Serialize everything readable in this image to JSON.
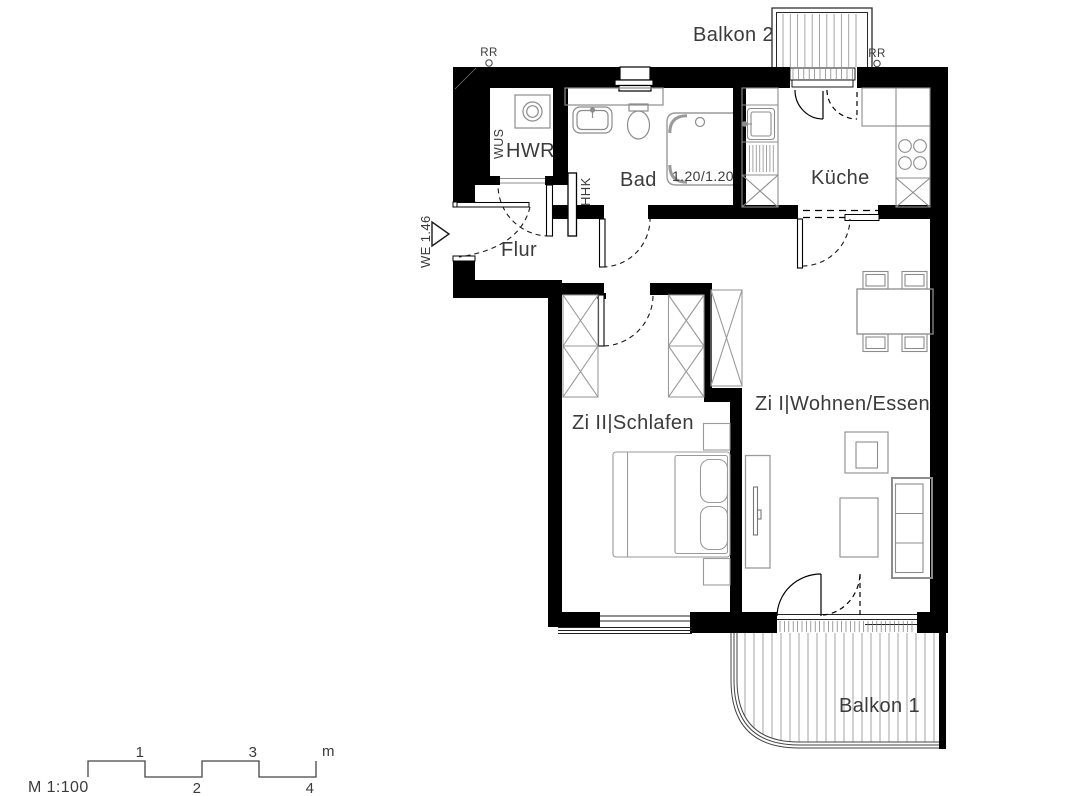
{
  "labels": {
    "balkon2": "Balkon 2",
    "balkon1": "Balkon 1",
    "hwr": "HWR",
    "bad": "Bad",
    "kueche": "Küche",
    "flur": "Flur",
    "zi2": "Zi II|Schlafen",
    "zi1": "Zi I|Wohnen/Essen"
  },
  "annotations": {
    "rr_left": "RR",
    "rr_right": "RR",
    "wus": "WUS",
    "hhk": "HHK",
    "we": "WE 1.46",
    "shower_dim": "1.20/1.20"
  },
  "scalebar": {
    "label": "M 1:100",
    "tick1": "1",
    "tick2": "2",
    "tick3": "3",
    "tick4": "4",
    "unit": "m"
  },
  "colors": {
    "wall": "#000000",
    "furniture_line": "#8c8c8c",
    "text": "#3b3b3b"
  }
}
